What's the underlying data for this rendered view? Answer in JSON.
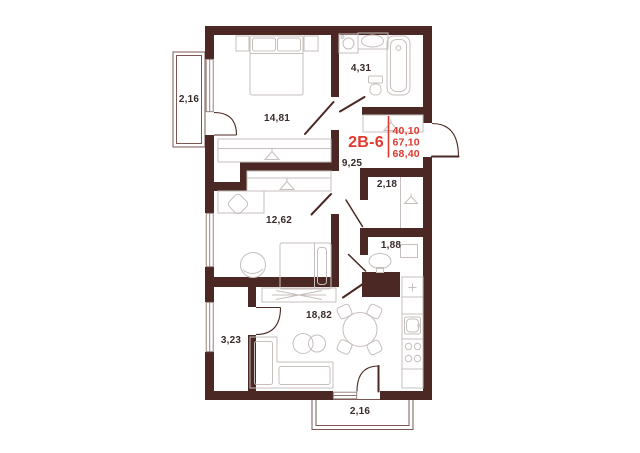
{
  "apartment": {
    "code": "2В-6",
    "area_living": "40,10",
    "area_total": "67,10",
    "area_total_with_balcony": "68,40"
  },
  "rooms": {
    "balcony_top": "2,16",
    "bedroom": "14,81",
    "bathroom": "4,31",
    "hallway": "9,25",
    "bedroom2": "12,62",
    "closet": "2,18",
    "wc": "1,88",
    "living_kitchen": "18,82",
    "pantry": "3,23",
    "balcony_bottom": "2,16"
  },
  "symbols": {
    "wardrobe_hanger": "hanger-icon",
    "fridge_plus": "plus-icon"
  },
  "colors": {
    "wall": "#4b2823",
    "accent": "#e2392f",
    "furniture_line": "#c6bfbc",
    "window_line": "#8d7670",
    "balcony_line": "#7a5750",
    "label_text": "#382b29",
    "background": "#ffffff"
  }
}
